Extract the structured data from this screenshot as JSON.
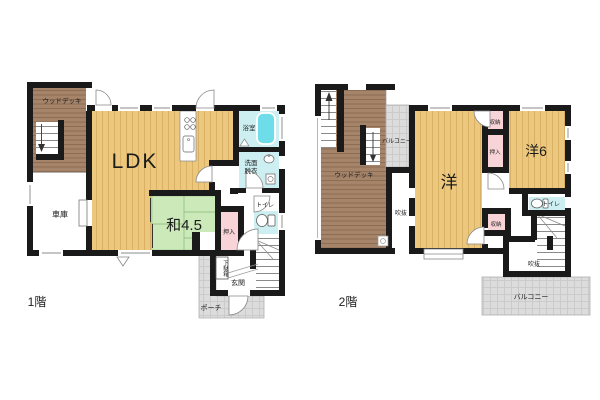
{
  "colors": {
    "wall": "#1a1a1a",
    "wood_deck_fill": "#a5846a",
    "flooring_fill": "#ecc87e",
    "tatami_fill": "#cbe9b9",
    "closet_fill": "#f8d3d8",
    "bath_fill": "#cdeff2",
    "bathtub_fill": "#6fdde9",
    "porch_fill": "#dcdcdc",
    "background": "#ffffff"
  },
  "icons": [
    "stove-icon",
    "kitchen-sink-icon",
    "bathtub-icon",
    "washbasin-icon",
    "washing-machine-icon",
    "toilet-icon",
    "stairs",
    "arrow-up-icon",
    "arrow-down-icon",
    "door-arc",
    "window",
    "bay-window"
  ],
  "floor1": {
    "name_label": "1階",
    "rooms": {
      "wood_deck": "ウッドデッキ",
      "ldk": "LDK",
      "garage": "車庫",
      "bath": "浴室",
      "washroom_lines": [
        "洗面",
        "脱衣"
      ],
      "japanese_room": "和4.5",
      "closet": "押入",
      "toilet": "トイレ",
      "shoe_cabinet": "下駄箱",
      "entrance": "玄関",
      "porch": "ポーチ"
    }
  },
  "floor2": {
    "name_label": "2階",
    "rooms": {
      "wood_deck": "ウッドデッキ",
      "balcony_upper": "バルコニー",
      "western_room": "洋",
      "storage_upper": "収納",
      "closet": "押入",
      "western_room_6": "洋6",
      "toilet": "トイレ",
      "void_upper": "吹抜",
      "storage_lower": "収納",
      "void_lower": "吹抜",
      "balcony_lower": "バルコニー"
    }
  }
}
